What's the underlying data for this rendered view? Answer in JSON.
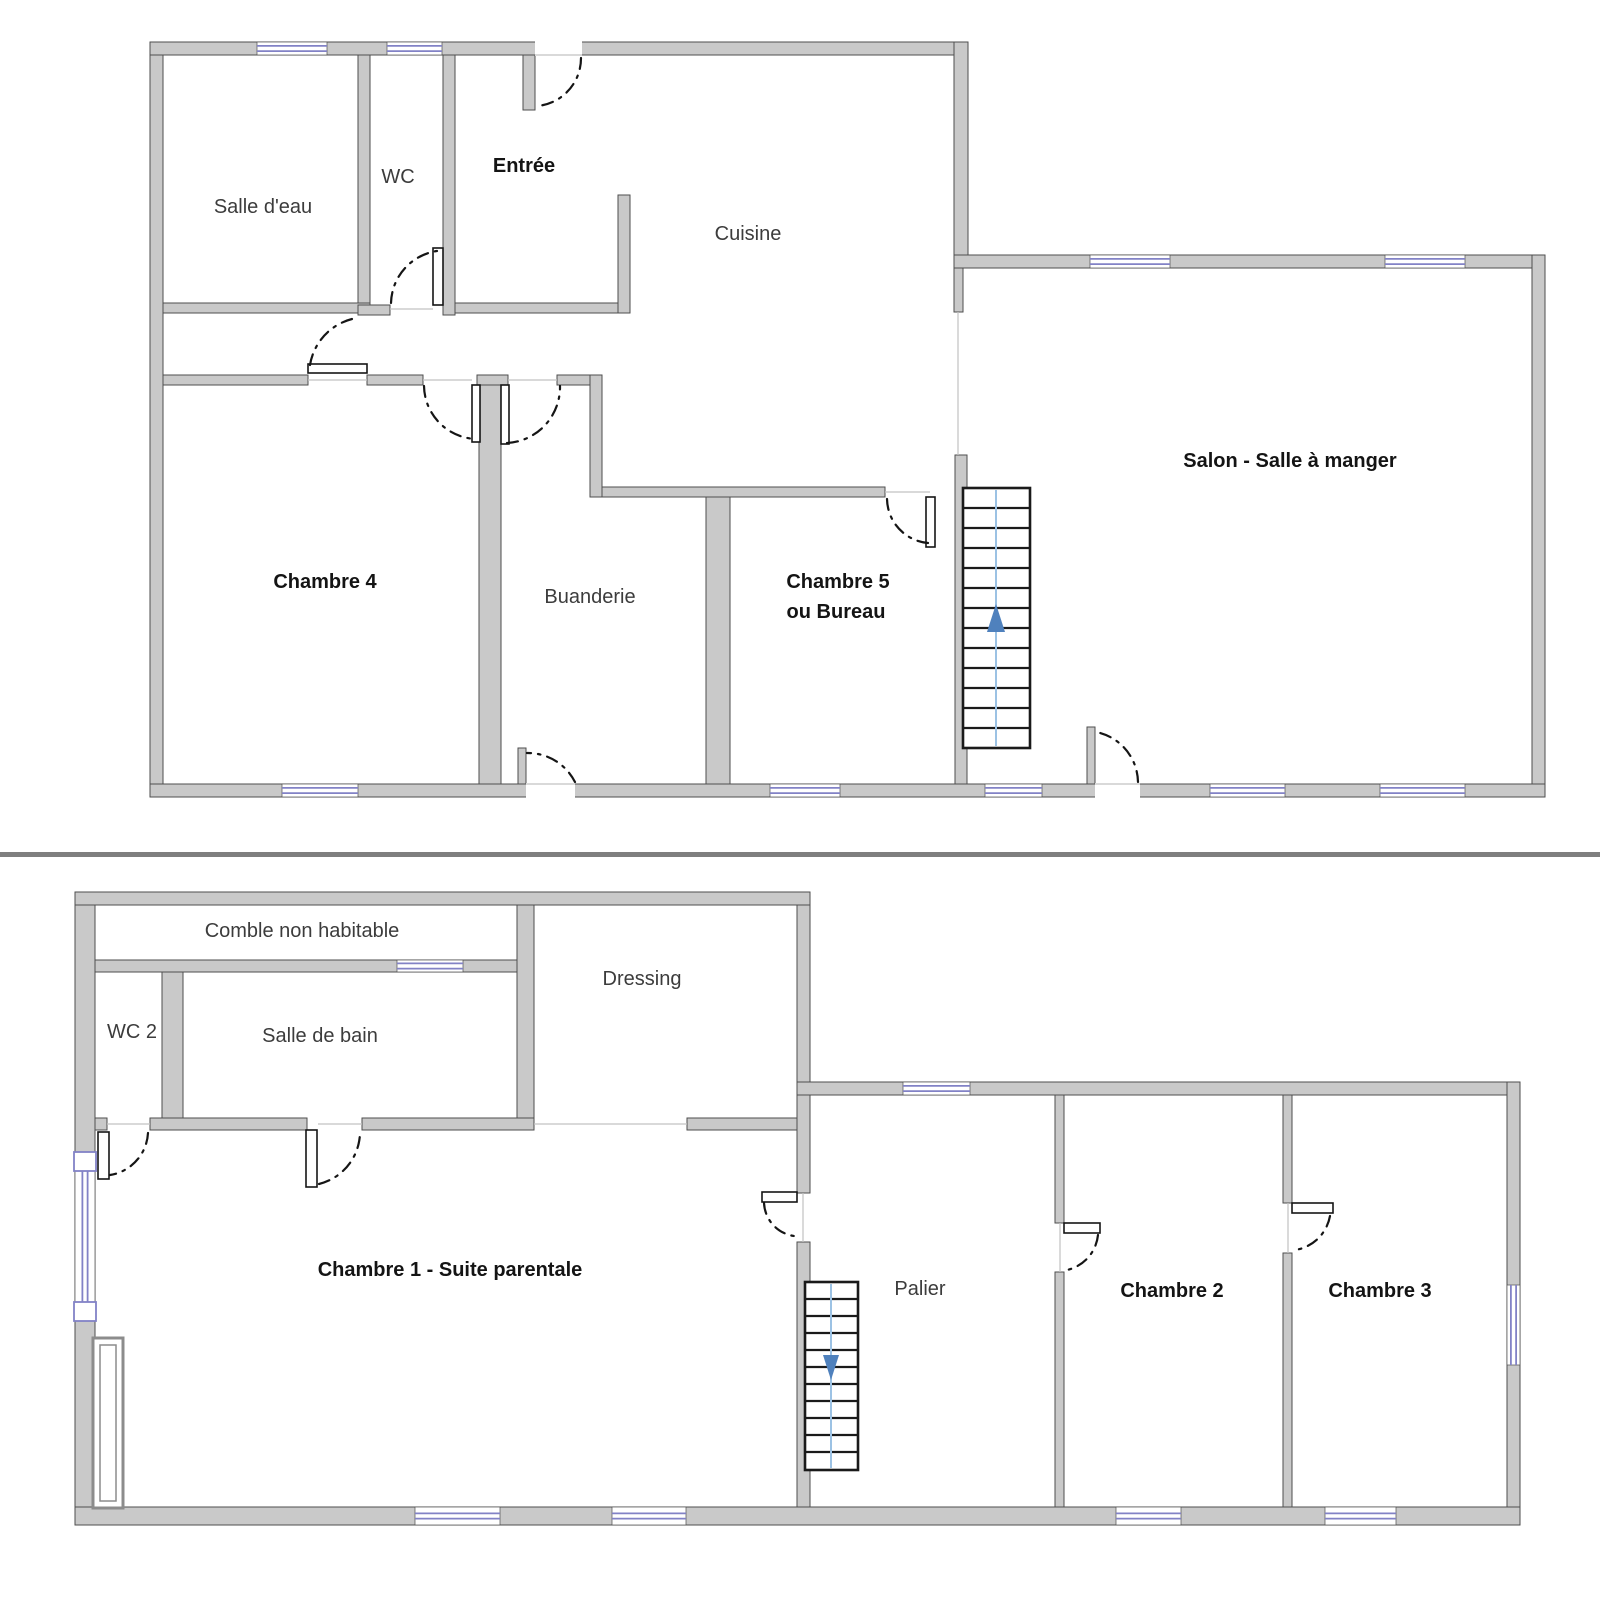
{
  "document": {
    "type": "floor-plan",
    "floor_count": 2
  },
  "colors": {
    "background": "#ffffff",
    "wall_fill": "#c9c9c9",
    "wall_stroke": "#4e4e4e",
    "window_blue": "#8282c6",
    "door_dash": "#151515",
    "stair_stroke": "#1a1a1a",
    "stair_guide_blue": "#9cc2e4",
    "stair_arrow_blue": "#4f81bd",
    "divider_gray": "#7f7f7f",
    "hairline": "#c2c2c2",
    "label_regular": "#3c3c3c",
    "label_bold": "#141414",
    "duct_stroke": "#8c8c8c"
  },
  "divider": {
    "x": 0,
    "y": 852,
    "width": 1600,
    "height": 5
  },
  "floors": [
    {
      "name": "ground-floor",
      "labels": [
        {
          "slug": "salle-deau",
          "text": "Salle d'eau",
          "x": 263,
          "y": 213,
          "bold": false
        },
        {
          "slug": "wc",
          "text": "WC",
          "x": 398,
          "y": 183,
          "bold": false
        },
        {
          "slug": "entree",
          "text": "Entrée",
          "x": 524,
          "y": 172,
          "bold": true
        },
        {
          "slug": "cuisine",
          "text": "Cuisine",
          "x": 748,
          "y": 240,
          "bold": false
        },
        {
          "slug": "chambre-4",
          "text": "Chambre 4",
          "x": 325,
          "y": 588,
          "bold": true
        },
        {
          "slug": "buanderie",
          "text": "Buanderie",
          "x": 590,
          "y": 603,
          "bold": false
        },
        {
          "slug": "chambre-5",
          "text": "Chambre 5",
          "x": 838,
          "y": 588,
          "bold": true
        },
        {
          "slug": "ou-bureau",
          "text": "ou Bureau",
          "x": 836,
          "y": 618,
          "bold": true
        },
        {
          "slug": "salon-salle-a-manger",
          "text": "Salon - Salle à manger",
          "x": 1290,
          "y": 467,
          "bold": true
        }
      ],
      "walls": [
        [
          150,
          42,
          13,
          755
        ],
        [
          150,
          42,
          818,
          13
        ],
        [
          954,
          42,
          14,
          226
        ],
        [
          954,
          255,
          591,
          13
        ],
        [
          1532,
          255,
          13,
          542
        ],
        [
          150,
          784,
          1395,
          13
        ],
        [
          523,
          55,
          12,
          55
        ],
        [
          358,
          55,
          12,
          250
        ],
        [
          443,
          55,
          12,
          260
        ],
        [
          163,
          303,
          207,
          10
        ],
        [
          358,
          305,
          32,
          10
        ],
        [
          455,
          303,
          175,
          10
        ],
        [
          618,
          195,
          12,
          118
        ],
        [
          163,
          375,
          145,
          10
        ],
        [
          367,
          375,
          56,
          10
        ],
        [
          477,
          375,
          31,
          10
        ],
        [
          479,
          385,
          22,
          399
        ],
        [
          557,
          375,
          45,
          10
        ],
        [
          590,
          375,
          12,
          122
        ],
        [
          602,
          487,
          283,
          10
        ],
        [
          706,
          497,
          24,
          287
        ],
        [
          955,
          455,
          12,
          329
        ],
        [
          954,
          268,
          9,
          44
        ],
        [
          518,
          748,
          8,
          36
        ],
        [
          1087,
          727,
          8,
          57
        ]
      ],
      "gaps": [
        [
          535,
          42,
          47,
          13
        ],
        [
          526,
          784,
          49,
          13
        ],
        [
          1095,
          784,
          45,
          13
        ]
      ],
      "windows": [
        [
          257,
          42,
          70,
          13
        ],
        [
          387,
          42,
          55,
          13
        ],
        [
          1090,
          255,
          80,
          13
        ],
        [
          1385,
          255,
          80,
          13
        ],
        [
          282,
          784,
          76,
          13
        ],
        [
          770,
          784,
          70,
          13
        ],
        [
          985,
          784,
          57,
          13
        ],
        [
          1210,
          784,
          75,
          13
        ],
        [
          1380,
          784,
          85,
          13
        ]
      ],
      "window_caps": [],
      "hairlines": [
        [
          535,
          55,
          582,
          55
        ],
        [
          390,
          309,
          433,
          309
        ],
        [
          308,
          380,
          367,
          380
        ],
        [
          423,
          380,
          472,
          380
        ],
        [
          508,
          380,
          557,
          380
        ],
        [
          885,
          492,
          930,
          492
        ],
        [
          958,
          312,
          958,
          455
        ],
        [
          526,
          784,
          575,
          784
        ],
        [
          1095,
          784,
          1140,
          784
        ]
      ],
      "door_leaves": [
        [
          433,
          248,
          10,
          57
        ],
        [
          308,
          364,
          59,
          9
        ],
        [
          472,
          385,
          8,
          57
        ],
        [
          501,
          385,
          8,
          59
        ],
        [
          926,
          497,
          9,
          50
        ]
      ],
      "door_arcs": [
        "M 581 58 A 48 48 0 0 1 537 106",
        "M 391 303 A 54 54 0 0 1 437 251",
        "M 310 365 A 57 57 0 0 1 352 319",
        "M 424 386 A 54 54 0 0 0 476 439",
        "M 507 443 A 56 56 0 0 0 560 386",
        "M 887 499 A 45 45 0 0 0 928 543",
        "M 575 782 A 53 53 0 0 0 527 753",
        "M 1138 782 A 52 52 0 0 0 1096 732"
      ],
      "stairs": {
        "box": [
          963,
          488,
          67,
          260
        ],
        "treads_y": [
          508,
          528,
          548,
          568,
          588,
          608,
          628,
          648,
          668,
          688,
          708,
          728
        ],
        "guide_x": 996,
        "guide_y1": 490,
        "guide_y2": 746,
        "arrow": {
          "direction": "up",
          "tip": [
            996,
            604
          ],
          "base": [
            [
              987,
              632
            ],
            [
              1005,
              632
            ]
          ]
        }
      },
      "ducts": []
    },
    {
      "name": "upper-floor",
      "labels": [
        {
          "slug": "comble-non-habitable",
          "text": "Comble non habitable",
          "x": 302,
          "y": 937,
          "bold": false
        },
        {
          "slug": "wc-2",
          "text": "WC 2",
          "x": 132,
          "y": 1038,
          "bold": false
        },
        {
          "slug": "salle-de-bain",
          "text": "Salle de bain",
          "x": 320,
          "y": 1042,
          "bold": false
        },
        {
          "slug": "dressing",
          "text": "Dressing",
          "x": 642,
          "y": 985,
          "bold": false
        },
        {
          "slug": "chambre-1-suite-parentale",
          "text": "Chambre 1 - Suite parentale",
          "x": 450,
          "y": 1276,
          "bold": true
        },
        {
          "slug": "palier",
          "text": "Palier",
          "x": 920,
          "y": 1295,
          "bold": false
        },
        {
          "slug": "chambre-2",
          "text": "Chambre 2",
          "x": 1172,
          "y": 1297,
          "bold": true
        },
        {
          "slug": "chambre-3",
          "text": "Chambre 3",
          "x": 1380,
          "y": 1297,
          "bold": true
        }
      ],
      "walls": [
        [
          75,
          892,
          20,
          633
        ],
        [
          75,
          892,
          735,
          13
        ],
        [
          797,
          905,
          13,
          190
        ],
        [
          797,
          1082,
          723,
          13
        ],
        [
          1507,
          1082,
          13,
          443
        ],
        [
          75,
          1507,
          1445,
          18
        ],
        [
          95,
          960,
          439,
          12
        ],
        [
          162,
          972,
          21,
          146
        ],
        [
          517,
          905,
          17,
          225
        ],
        [
          95,
          1118,
          12,
          12
        ],
        [
          150,
          1118,
          157,
          12
        ],
        [
          362,
          1118,
          172,
          12
        ],
        [
          687,
          1118,
          110,
          12
        ],
        [
          797,
          1095,
          13,
          98
        ],
        [
          797,
          1242,
          13,
          265
        ],
        [
          1055,
          1095,
          9,
          128
        ],
        [
          1055,
          1272,
          9,
          235
        ],
        [
          1283,
          1095,
          9,
          108
        ],
        [
          1283,
          1253,
          9,
          254
        ]
      ],
      "gaps": [],
      "windows": [
        [
          397,
          960,
          66,
          12
        ],
        [
          903,
          1082,
          67,
          13
        ],
        [
          1507,
          1285,
          13,
          80
        ],
        [
          75,
          1170,
          20,
          133
        ],
        [
          415,
          1507,
          85,
          18
        ],
        [
          612,
          1507,
          74,
          18
        ],
        [
          1116,
          1507,
          65,
          18
        ],
        [
          1325,
          1507,
          71,
          18
        ]
      ],
      "window_caps": [
        [
          74,
          1152,
          22,
          19
        ],
        [
          74,
          1302,
          22,
          19
        ]
      ],
      "hairlines": [
        [
          107,
          1124,
          150,
          1124
        ],
        [
          318,
          1124,
          362,
          1124
        ],
        [
          534,
          1124,
          687,
          1124
        ],
        [
          803,
          1193,
          803,
          1242
        ],
        [
          1060,
          1223,
          1060,
          1272
        ],
        [
          1288,
          1203,
          1288,
          1253
        ]
      ],
      "door_leaves": [
        [
          98,
          1132,
          11,
          47
        ],
        [
          306,
          1130,
          11,
          57
        ],
        [
          762,
          1192,
          35,
          10
        ],
        [
          1064,
          1223,
          36,
          10
        ],
        [
          1292,
          1203,
          41,
          10
        ]
      ],
      "door_arcs": [
        "M 148 1133 A 45 45 0 0 1 110 1175",
        "M 319 1184 A 54 54 0 0 0 360 1133",
        "M 764 1203 A 35 35 0 0 0 794 1236",
        "M 1098 1235 A 40 40 0 0 1 1067 1270",
        "M 1330 1216 A 42 42 0 0 1 1295 1250"
      ],
      "stairs": {
        "box": [
          805,
          1282,
          53,
          188
        ],
        "treads_y": [
          1299,
          1316,
          1333,
          1350,
          1367,
          1384,
          1401,
          1418,
          1435,
          1452
        ],
        "guide_x": 831,
        "guide_y1": 1284,
        "guide_y2": 1468,
        "arrow": {
          "direction": "down",
          "tip": [
            831,
            1380
          ],
          "base": [
            [
              823,
              1355
            ],
            [
              839,
              1355
            ]
          ]
        }
      },
      "ducts": [
        {
          "outer": [
            93,
            1338,
            30,
            170
          ],
          "inner": [
            100,
            1345,
            16,
            156
          ]
        }
      ]
    }
  ]
}
